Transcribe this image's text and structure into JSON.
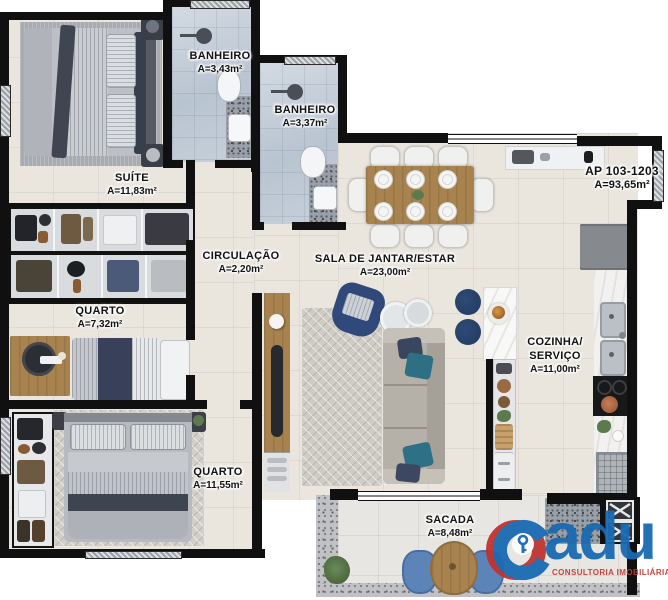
{
  "apartment": {
    "label": "AP 103-1203",
    "area": "A=93,65m²"
  },
  "rooms": {
    "suite": {
      "name": "SUÍTE",
      "area": "A=11,83m²"
    },
    "banheiro1": {
      "name": "BANHEIRO",
      "area": "A=3,43m²"
    },
    "banheiro2": {
      "name": "BANHEIRO",
      "area": "A=3,37m²"
    },
    "circulacao": {
      "name": "CIRCULAÇÃO",
      "area": "A=2,20m²"
    },
    "quarto1": {
      "name": "QUARTO",
      "area": "A=7,32m²"
    },
    "quarto2": {
      "name": "QUARTO",
      "area": "A=11,55m²"
    },
    "sala": {
      "name": "SALA DE JANTAR/ESTAR",
      "area": "A=23,00m²"
    },
    "cozinha": {
      "name_line1": "COZINHA/",
      "name_line2": "SERVIÇO",
      "area": "A=11,00m²"
    },
    "sacada": {
      "name": "SACADA",
      "area": "A=8,48m²"
    }
  },
  "logo": {
    "brand": "Cadu",
    "brand_rest": "adu",
    "tagline": "CONSULTORIA IMOBILIÁRIA",
    "colors": {
      "blue": "#1a6ab2",
      "red": "#c0332f"
    }
  }
}
